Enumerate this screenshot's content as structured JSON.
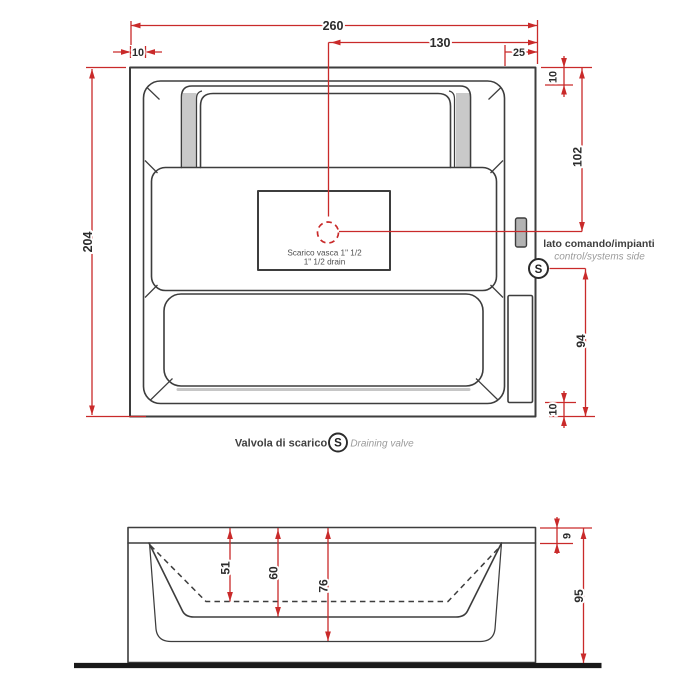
{
  "plan": {
    "dim_overall_width": "260",
    "dim_center_to_right": "130",
    "dim_right_inset": "25",
    "dim_left_inset": "10",
    "dim_overall_depth": "204",
    "dim_top_inset": "10",
    "dim_top_to_drain": "102",
    "dim_drain_to_bottom": "94",
    "dim_bottom_inset": "10",
    "drain_note_it": "Scarico vasca 1\" 1/2",
    "drain_note_en": "1\" 1/2  drain",
    "side_note_it": "lato comando/impianti",
    "side_note_en": "control/systems side",
    "valve_symbol": "S"
  },
  "legend": {
    "valve_it": "Valvola di scarico",
    "valve_symbol": "S",
    "valve_en": "Draining valve"
  },
  "section": {
    "dim_depth_to_seat": "51",
    "dim_depth_inner": "60",
    "dim_depth_shell": "76",
    "dim_rim_height": "9",
    "dim_total_height": "95"
  },
  "colors": {
    "line": "#3d3d3d",
    "red": "#c92a2a",
    "tdark": "#2b2b2b",
    "tgray": "#9b9b9b",
    "panel": "#b3b3b3",
    "floor": "#191919"
  }
}
